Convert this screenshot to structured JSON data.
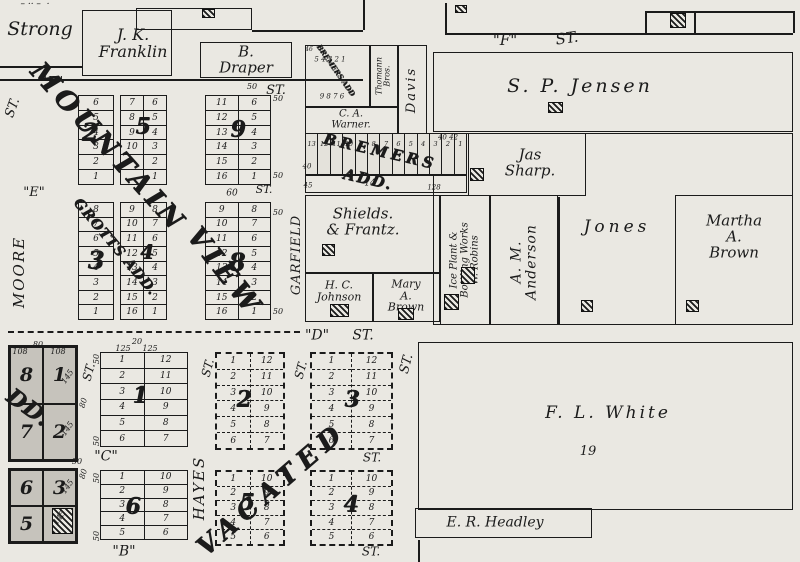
{
  "canvas": {
    "w": 800,
    "h": 562,
    "paper": "#eae8e2",
    "ink": "#1b1b1b",
    "shade": "#c6c3bc"
  },
  "texts": [
    {
      "t": "– ·· –  ·",
      "x": 35,
      "y": 5,
      "s": 9,
      "name": "torn-edge-marks"
    },
    {
      "t": "\"F\"",
      "x": 52,
      "y": 83,
      "s": 14,
      "name": "street-f-left"
    },
    {
      "t": "ST.",
      "x": 13,
      "y": 108,
      "s": 13,
      "r": -70,
      "name": "street-f-left-st"
    },
    {
      "t": "\"F\"",
      "x": 505,
      "y": 41,
      "s": 15,
      "name": "street-f-right"
    },
    {
      "t": "ST.",
      "x": 567,
      "y": 39,
      "s": 15,
      "r": -8,
      "name": "street-f-right-st"
    },
    {
      "t": "ST.",
      "x": 276,
      "y": 91,
      "s": 13,
      "name": "street-st-draper"
    },
    {
      "t": "50",
      "x": 252,
      "y": 87,
      "s": 8,
      "name": "dim"
    },
    {
      "t": "\"E\"",
      "x": 34,
      "y": 193,
      "s": 13,
      "name": "street-e"
    },
    {
      "t": "MOORE",
      "x": 20,
      "y": 272,
      "s": 15,
      "r": -90,
      "sp": 2,
      "name": "street-moore"
    },
    {
      "t": "GARFIELD",
      "x": 297,
      "y": 255,
      "s": 13,
      "r": -90,
      "sp": 1,
      "name": "street-garfield"
    },
    {
      "t": "ST.",
      "x": 264,
      "y": 190,
      "s": 11,
      "name": "street-garfield-st"
    },
    {
      "t": "60",
      "x": 232,
      "y": 194,
      "s": 9,
      "name": "dim"
    },
    {
      "t": "\"D\"",
      "x": 317,
      "y": 336,
      "s": 14,
      "name": "street-d"
    },
    {
      "t": "ST.",
      "x": 363,
      "y": 336,
      "s": 14,
      "name": "street-d-st"
    },
    {
      "t": "ST.",
      "x": 89,
      "y": 372,
      "s": 12,
      "r": -75,
      "name": "street-st-west"
    },
    {
      "t": "ST.",
      "x": 208,
      "y": 368,
      "s": 12,
      "r": -75,
      "name": "street-hayes-st"
    },
    {
      "t": "HAYES",
      "x": 200,
      "y": 488,
      "s": 15,
      "r": -90,
      "sp": 2,
      "name": "street-hayes"
    },
    {
      "t": "ST.",
      "x": 301,
      "y": 370,
      "s": 12,
      "r": -75,
      "name": "street-st-mid"
    },
    {
      "t": "ST.",
      "x": 407,
      "y": 364,
      "s": 13,
      "r": -75,
      "name": "street-st-white"
    },
    {
      "t": "ST.",
      "x": 372,
      "y": 458,
      "s": 12,
      "name": "street-st-right-mid"
    },
    {
      "t": "ST.",
      "x": 371,
      "y": 552,
      "s": 12,
      "name": "street-st-bottom"
    },
    {
      "t": "\"C\"",
      "x": 106,
      "y": 457,
      "s": 14,
      "name": "street-c"
    },
    {
      "t": "\"B\"",
      "x": 124,
      "y": 552,
      "s": 14,
      "name": "street-b"
    },
    {
      "t": "50",
      "x": 278,
      "y": 99,
      "s": 8,
      "name": "dim"
    },
    {
      "t": "50",
      "x": 278,
      "y": 176,
      "s": 8,
      "name": "dim"
    },
    {
      "t": "50",
      "x": 278,
      "y": 213,
      "s": 8,
      "name": "dim"
    },
    {
      "t": "50",
      "x": 278,
      "y": 312,
      "s": 8,
      "name": "dim"
    },
    {
      "t": "108",
      "x": 20,
      "y": 352,
      "s": 8,
      "name": "dim"
    },
    {
      "t": "80",
      "x": 38,
      "y": 345,
      "s": 8,
      "name": "dim"
    },
    {
      "t": "108",
      "x": 58,
      "y": 352,
      "s": 8,
      "name": "dim"
    },
    {
      "t": "145",
      "x": 68,
      "y": 377,
      "s": 8,
      "r": -55,
      "name": "dim"
    },
    {
      "t": "145",
      "x": 68,
      "y": 429,
      "s": 8,
      "r": -55,
      "name": "dim"
    },
    {
      "t": "145",
      "x": 68,
      "y": 487,
      "s": 8,
      "r": -55,
      "name": "dim"
    },
    {
      "t": "145",
      "x": 60,
      "y": 518,
      "s": 8,
      "r": -55,
      "name": "dim"
    },
    {
      "t": "50",
      "x": 77,
      "y": 462,
      "s": 8,
      "name": "dim"
    },
    {
      "t": "125",
      "x": 123,
      "y": 349,
      "s": 8,
      "name": "dim"
    },
    {
      "t": "20",
      "x": 137,
      "y": 342,
      "s": 8,
      "name": "dim"
    },
    {
      "t": "125",
      "x": 150,
      "y": 349,
      "s": 8,
      "name": "dim"
    },
    {
      "t": "50",
      "x": 97,
      "y": 359,
      "s": 8,
      "r": -90,
      "name": "dim"
    },
    {
      "t": "50",
      "x": 97,
      "y": 441,
      "s": 8,
      "r": -90,
      "name": "dim"
    },
    {
      "t": "50",
      "x": 97,
      "y": 478,
      "s": 8,
      "r": -90,
      "name": "dim"
    },
    {
      "t": "50",
      "x": 97,
      "y": 536,
      "s": 8,
      "r": -90,
      "name": "dim"
    },
    {
      "t": "80",
      "x": 84,
      "y": 403,
      "s": 8,
      "r": -75,
      "name": "dim"
    },
    {
      "t": "80",
      "x": 84,
      "y": 474,
      "s": 8,
      "r": -75,
      "name": "dim"
    },
    {
      "t": "40",
      "x": 307,
      "y": 167,
      "s": 7,
      "name": "dim"
    },
    {
      "t": "40 42",
      "x": 448,
      "y": 138,
      "s": 7,
      "name": "dim"
    },
    {
      "t": "45",
      "x": 308,
      "y": 186,
      "s": 7,
      "name": "dim"
    },
    {
      "t": "14",
      "x": 370,
      "y": 184,
      "s": 9,
      "name": "lot-14"
    },
    {
      "t": "128",
      "x": 434,
      "y": 188,
      "s": 7,
      "name": "dim"
    },
    {
      "t": "46",
      "x": 309,
      "y": 50,
      "s": 6,
      "name": "dim"
    },
    {
      "t": "5 4 3 2 1",
      "x": 330,
      "y": 60,
      "s": 7,
      "name": "tiny-lot-numbers"
    },
    {
      "t": "9 8 7 6",
      "x": 332,
      "y": 97,
      "s": 7,
      "name": "tiny-lot-numbers"
    },
    {
      "t": "19",
      "x": 588,
      "y": 452,
      "s": 13,
      "name": "white-parcel-number"
    },
    {
      "t": "MOUNTAIN",
      "x": 108,
      "y": 148,
      "s": 27,
      "r": 48,
      "sp": 5,
      "ov": 1,
      "name": "overlay-mountain"
    },
    {
      "t": "VIEW",
      "x": 224,
      "y": 272,
      "s": 27,
      "r": 52,
      "sp": 5,
      "ov": 1,
      "name": "overlay-view"
    },
    {
      "t": "GROTTS ADD.",
      "x": 115,
      "y": 247,
      "s": 14,
      "r": 50,
      "sp": 1,
      "ov": 1,
      "name": "overlay-grotts-add"
    },
    {
      "t": "DD.",
      "x": 28,
      "y": 408,
      "s": 22,
      "r": 36,
      "sp": 1,
      "ov": 1,
      "name": "overlay-add-cutoff"
    },
    {
      "t": "VACATED",
      "x": 272,
      "y": 490,
      "s": 26,
      "r": -41,
      "sp": 7,
      "ov": 1,
      "name": "overlay-vacated"
    },
    {
      "t": "BREMERS",
      "x": 380,
      "y": 152,
      "s": 15,
      "r": 13,
      "sp": 4,
      "ov": 1,
      "name": "overlay-bremers"
    },
    {
      "t": "ADD.",
      "x": 368,
      "y": 180,
      "s": 15,
      "r": 13,
      "sp": 2,
      "ov": 1,
      "name": "overlay-bremers-add"
    },
    {
      "t": "BREMERS ADD",
      "x": 336,
      "y": 70,
      "s": 7,
      "r": 55,
      "sp": 0,
      "ov": 1,
      "name": "overlay-bremers-tiny"
    }
  ],
  "parcels": [
    {
      "name": "strong",
      "lines": [
        "Strong"
      ],
      "cx": 40,
      "cy": 30,
      "s": 19
    },
    {
      "name": "jk-franklin",
      "box": [
        82,
        10,
        90,
        66
      ],
      "lines": [
        "J. K.",
        "Franklin"
      ],
      "cx": 133,
      "cy": 44,
      "s": 16
    },
    {
      "name": "top-parcel",
      "box": [
        136,
        8,
        116,
        22
      ]
    },
    {
      "name": "b-draper",
      "box": [
        200,
        42,
        92,
        36
      ],
      "lines": [
        "B.",
        "Draper"
      ],
      "cx": 246,
      "cy": 60,
      "s": 15
    },
    {
      "name": "sp-jensen",
      "box": [
        433,
        52,
        360,
        80
      ],
      "lines": [
        "S. P. Jensen"
      ],
      "cx": 580,
      "cy": 87,
      "s": 19,
      "sp": 3
    },
    {
      "name": "east-block",
      "box": [
        433,
        133,
        360,
        192
      ]
    },
    {
      "name": "jas-sharp",
      "box": [
        468,
        133,
        118,
        63
      ],
      "lines": [
        "Jas",
        "Sharp."
      ],
      "cx": 530,
      "cy": 163,
      "s": 15
    },
    {
      "name": "thomann-bros",
      "box": [
        370,
        45,
        28,
        62
      ],
      "lines": [
        "Thomann",
        "Bros."
      ],
      "cx": 384,
      "cy": 76,
      "s": 8,
      "r": -90
    },
    {
      "name": "davis",
      "box": [
        398,
        45,
        29,
        92
      ],
      "lines": [
        "Davis"
      ],
      "cx": 412,
      "cy": 90,
      "s": 13,
      "r": -90,
      "sp": 2
    },
    {
      "name": "ca-warner",
      "box": [
        305,
        107,
        93,
        28
      ],
      "lines": [
        "C. A.",
        "Warner."
      ],
      "cx": 351,
      "cy": 120,
      "s": 10
    },
    {
      "name": "tiny-lots",
      "box": [
        305,
        45,
        65,
        62
      ]
    },
    {
      "name": "shields-frantz",
      "box": [
        305,
        195,
        135,
        78
      ],
      "lines": [
        "Shields.",
        "& Frantz."
      ],
      "cx": 363,
      "cy": 222,
      "s": 15
    },
    {
      "name": "hc-johnson",
      "box": [
        305,
        273,
        68,
        49
      ],
      "lines": [
        "H. C.",
        "Johnson"
      ],
      "cx": 339,
      "cy": 291,
      "s": 11
    },
    {
      "name": "mary-a-brown",
      "box": [
        373,
        273,
        67,
        49
      ],
      "lines": [
        "Mary",
        "A.",
        "Brown"
      ],
      "cx": 406,
      "cy": 296,
      "s": 11
    },
    {
      "name": "ice-plant-w-robins",
      "box": [
        440,
        195,
        50,
        130
      ],
      "lines": [
        "Ice Plant &",
        "Bottling Works",
        "W. Robins"
      ],
      "cx": 465,
      "cy": 260,
      "s": 10,
      "r": -90
    },
    {
      "name": "am-anderson",
      "box": [
        490,
        195,
        68,
        130
      ],
      "lines": [
        "A. M.",
        "Anderson"
      ],
      "cx": 524,
      "cy": 262,
      "s": 14,
      "r": -90,
      "sp": 1
    },
    {
      "name": "jones",
      "lines": [
        "Jones"
      ],
      "cx": 617,
      "cy": 228,
      "s": 17,
      "sp": 4
    },
    {
      "name": "martha-a-brown",
      "box": [
        675,
        195,
        118,
        130
      ],
      "lines": [
        "Martha",
        "A.",
        "Brown"
      ],
      "cx": 734,
      "cy": 237,
      "s": 15
    },
    {
      "name": "bremers-lot-14",
      "box": [
        305,
        175,
        162,
        18
      ]
    },
    {
      "name": "fl-white",
      "box": [
        418,
        342,
        375,
        168
      ],
      "lines": [
        "F. L. White"
      ],
      "cx": 608,
      "cy": 414,
      "s": 17,
      "sp": 3
    },
    {
      "name": "er-headley",
      "box": [
        415,
        508,
        177,
        30
      ],
      "lines": [
        "E. R. Headley"
      ],
      "cx": 495,
      "cy": 523,
      "s": 14
    }
  ],
  "blocks": [
    {
      "name": "2",
      "x": 78,
      "y": 95,
      "w": 36,
      "h": 90,
      "cols": [
        [
          "6",
          "5",
          "4",
          "3",
          "2",
          "1"
        ]
      ],
      "num": "2",
      "nx": 90,
      "ny": 132,
      "ns": 24
    },
    {
      "name": "5",
      "x": 120,
      "y": 95,
      "w": 47,
      "h": 90,
      "cols": [
        [
          "7",
          "8",
          "9",
          "10",
          "",
          ""
        ],
        [
          "6",
          "5",
          "4",
          "3",
          "2",
          "1"
        ]
      ],
      "num": "5",
      "nx": 143,
      "ny": 127,
      "ns": 22
    },
    {
      "name": "9",
      "x": 205,
      "y": 95,
      "w": 66,
      "h": 90,
      "cols": [
        [
          "11",
          "12",
          "13",
          "14",
          "15",
          "16"
        ],
        [
          "6",
          "5",
          "4",
          "3",
          "2",
          "1"
        ]
      ],
      "num": "9",
      "nx": 238,
      "ny": 130,
      "ns": 22
    },
    {
      "name": "3",
      "x": 78,
      "y": 202,
      "w": 36,
      "h": 118,
      "cols": [
        [
          "8",
          "7",
          "6",
          "5",
          "4",
          "3",
          "2",
          "1"
        ]
      ],
      "num": "3",
      "nx": 96,
      "ny": 260,
      "ns": 24
    },
    {
      "name": "4",
      "x": 120,
      "y": 202,
      "w": 47,
      "h": 118,
      "cols": [
        [
          "9",
          "10",
          "11",
          "12",
          "13",
          "14",
          "15",
          "16"
        ],
        [
          "8",
          "7",
          "6",
          "5",
          "4",
          "3",
          "2",
          "1"
        ]
      ],
      "num": "4",
      "nx": 147,
      "ny": 252,
      "ns": 20
    },
    {
      "name": "8",
      "x": 205,
      "y": 202,
      "w": 66,
      "h": 118,
      "cols": [
        [
          "9",
          "10",
          "11",
          "12",
          "13",
          "14",
          "15",
          "16"
        ],
        [
          "8",
          "7",
          "6",
          "5",
          "4",
          "3",
          "2",
          "1"
        ]
      ],
      "num": "8",
      "nx": 237,
      "ny": 262,
      "ns": 24
    },
    {
      "name": "1",
      "x": 100,
      "y": 352,
      "w": 88,
      "h": 95,
      "cols": [
        [
          "1",
          "2",
          "3",
          "4",
          "5",
          "6"
        ],
        [
          "12",
          "11",
          "10",
          "9",
          "8",
          "7"
        ]
      ],
      "num": "1",
      "nx": 140,
      "ny": 396,
      "ns": 22
    },
    {
      "name": "6",
      "x": 100,
      "y": 470,
      "w": 88,
      "h": 70,
      "cols": [
        [
          "1",
          "2",
          "3",
          "4",
          "5"
        ],
        [
          "10",
          "9",
          "8",
          "7",
          "6"
        ]
      ],
      "num": "6",
      "nx": 133,
      "ny": 507,
      "ns": 22
    },
    {
      "name": "2-vacated",
      "x": 215,
      "y": 352,
      "w": 70,
      "h": 98,
      "dash": 1,
      "cols": [
        [
          "1",
          "2",
          "3",
          "4",
          "5",
          "6"
        ],
        [
          "12",
          "11",
          "10",
          "9",
          "8",
          "7"
        ]
      ],
      "num": "2",
      "nx": 244,
      "ny": 400,
      "ns": 22
    },
    {
      "name": "3-vacated",
      "x": 310,
      "y": 352,
      "w": 83,
      "h": 98,
      "dash": 1,
      "cols": [
        [
          "1",
          "2",
          "3",
          "4",
          "5",
          "6"
        ],
        [
          "12",
          "11",
          "10",
          "9",
          "8",
          "7"
        ]
      ],
      "num": "3",
      "nx": 352,
      "ny": 400,
      "ns": 22
    },
    {
      "name": "5-vacated",
      "x": 215,
      "y": 470,
      "w": 70,
      "h": 76,
      "dash": 1,
      "cols": [
        [
          "1",
          "2",
          "3",
          "4",
          "5"
        ],
        [
          "10",
          "9",
          "8",
          "7",
          "6"
        ]
      ],
      "num": "5",
      "nx": 247,
      "ny": 503,
      "ns": 22
    },
    {
      "name": "4-vacated",
      "x": 310,
      "y": 470,
      "w": 83,
      "h": 76,
      "dash": 1,
      "cols": [
        [
          "1",
          "2",
          "3",
          "4",
          "5"
        ],
        [
          "10",
          "9",
          "8",
          "7",
          "6"
        ]
      ],
      "num": "4",
      "nx": 351,
      "ny": 505,
      "ns": 22
    }
  ],
  "shaded_blocks": [
    {
      "name": "grey-north",
      "x": 8,
      "y": 345,
      "w": 70,
      "h": 117,
      "rows": [
        [
          "8",
          "1"
        ],
        [
          "7",
          "2"
        ]
      ]
    },
    {
      "name": "grey-south",
      "x": 8,
      "y": 468,
      "w": 70,
      "h": 76,
      "rows": [
        [
          "6",
          "3"
        ],
        [
          "5",
          "4"
        ]
      ]
    }
  ],
  "strip": {
    "name": "bremers-strip",
    "x": 305,
    "y": 133,
    "w": 162,
    "h": 42,
    "cells": [
      "13",
      "12",
      "11",
      "10",
      "9",
      "8",
      "7",
      "6",
      "5",
      "4",
      "3",
      "2",
      "1"
    ]
  },
  "hatches": [
    [
      202,
      9,
      13,
      9
    ],
    [
      455,
      5,
      12,
      8
    ],
    [
      670,
      13,
      16,
      15
    ],
    [
      548,
      102,
      15,
      11
    ],
    [
      470,
      168,
      14,
      13
    ],
    [
      322,
      244,
      13,
      12
    ],
    [
      330,
      304,
      19,
      13
    ],
    [
      398,
      308,
      16,
      12
    ],
    [
      444,
      294,
      15,
      16
    ],
    [
      461,
      267,
      14,
      17
    ],
    [
      581,
      300,
      12,
      12
    ],
    [
      686,
      300,
      13,
      12
    ],
    [
      52,
      508,
      21,
      26
    ]
  ],
  "lines": [
    {
      "x": 0,
      "y": 66,
      "w": 82,
      "h": 0,
      "name": "boundary"
    },
    {
      "x": 0,
      "y": 79,
      "w": 363,
      "h": 0,
      "name": "street-f-edge"
    },
    {
      "x": 252,
      "y": 30,
      "w": 111,
      "h": 0,
      "name": "boundary"
    },
    {
      "x": 363,
      "y": 0,
      "w": 0,
      "h": 30,
      "name": "boundary"
    },
    {
      "x": 445,
      "y": 3,
      "w": 0,
      "h": 30,
      "name": "boundary"
    },
    {
      "x": 445,
      "y": 33,
      "w": 348,
      "h": 0,
      "name": "street-f-edge-right"
    },
    {
      "x": 645,
      "y": 11,
      "w": 0,
      "h": 22,
      "name": "boundary"
    },
    {
      "x": 694,
      "y": 11,
      "w": 0,
      "h": 22,
      "name": "boundary"
    },
    {
      "x": 645,
      "y": 11,
      "w": 148,
      "h": 0,
      "name": "boundary"
    },
    {
      "x": 793,
      "y": 11,
      "w": 0,
      "h": 22,
      "name": "boundary"
    },
    {
      "x": 558,
      "y": 197,
      "w": 0,
      "h": 128,
      "name": "parcel-divider"
    },
    {
      "x": 8,
      "y": 331,
      "w": 292,
      "h": 0,
      "dash": 1,
      "name": "street-d-dashed"
    },
    {
      "x": 418,
      "y": 540,
      "w": 0,
      "h": 22,
      "name": "boundary"
    }
  ]
}
